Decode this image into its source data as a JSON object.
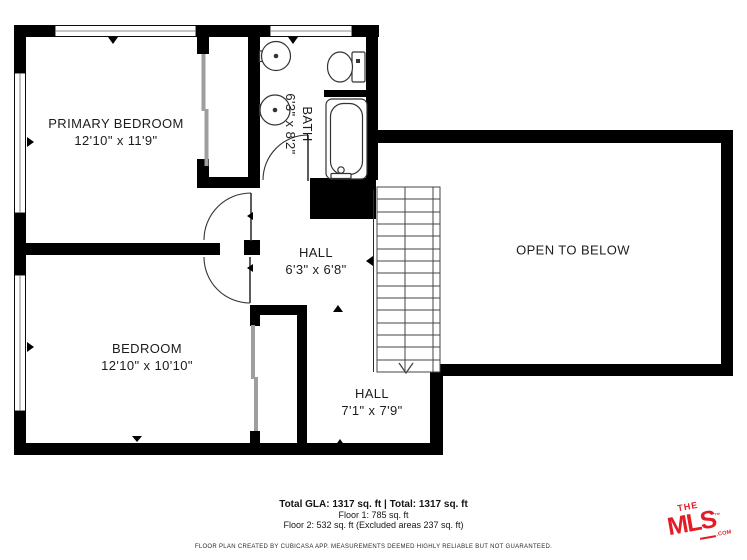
{
  "plan": {
    "rooms": [
      {
        "name": "PRIMARY BEDROOM",
        "dims": "12'10\" x 11'9\""
      },
      {
        "name": "BATH",
        "dims": "6'3\" x 8'2\""
      },
      {
        "name": "HALL",
        "dims": "6'3\" x 6'8\""
      },
      {
        "name": "BEDROOM",
        "dims": "12'10\" x 10'10\""
      },
      {
        "name": "HALL",
        "dims": "7'1\" x 7'9\""
      },
      {
        "name": "OPEN TO BELOW",
        "dims": ""
      }
    ],
    "wall_color": "#000000"
  },
  "summary": {
    "total_line": "Total GLA: 1317 sq. ft | Total: 1317 sq. ft",
    "floor1_line": "Floor 1: 785 sq. ft",
    "floor2_line": "Floor 2: 532 sq. ft (Excluded areas 237 sq. ft)"
  },
  "disclaimer": "FLOOR PLAN CREATED BY CUBICASA APP. MEASUREMENTS DEEMED HIGHLY RELIABLE BUT NOT GUARANTEED.",
  "logo": {
    "the": "THE",
    "mls": "MLS",
    "tm": "™",
    "com": ".COM",
    "color": "#e21d25"
  }
}
